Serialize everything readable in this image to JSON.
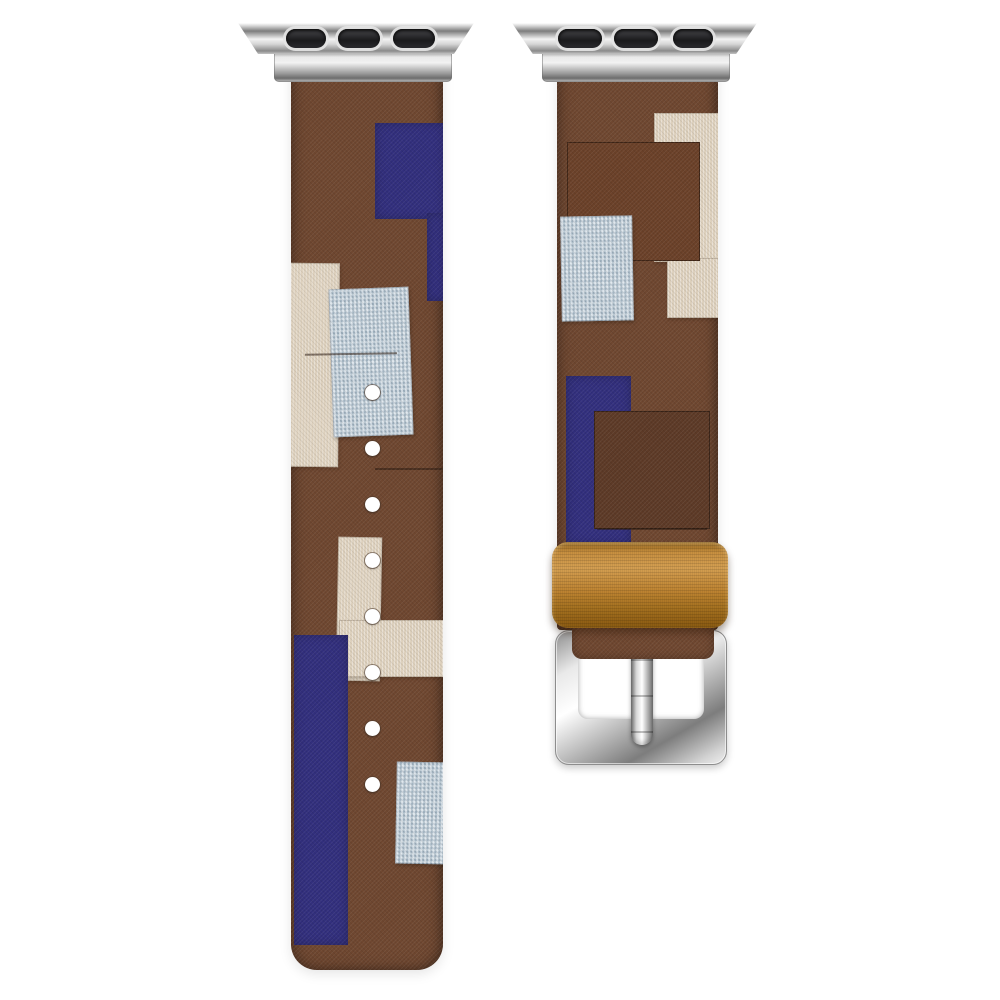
{
  "meta": {
    "type": "product-photo",
    "subject": "Patchwork fabric watch band with silver lug adapters and pin buckle",
    "background_style": "plain white studio background",
    "visible_text": ""
  },
  "product": {
    "pattern": "patchwork color-block fabric",
    "left_strap": {
      "holes_count": 8,
      "hole_color": "white"
    },
    "right_strap": {
      "has_keeper_loop": true,
      "has_buckle": true
    },
    "adapters": {
      "count": 2,
      "slots_per_adapter": 3,
      "finish": "polished silver"
    },
    "keeper": {
      "material_look": "tan leather"
    },
    "buckle": {
      "type": "pin buckle",
      "finish": "polished silver",
      "prong_count": 1
    }
  },
  "colors": {
    "background": "#ffffff",
    "brown": "#6f4730",
    "brown-red": "#6b4129",
    "brown-dark": "#5d3a27",
    "navy": "#322f7d",
    "lightblue": "#b6c8d5",
    "cream": "#ddd0bc",
    "tan": "#c08634",
    "tan-light": "#d49f52",
    "tan-dark": "#8a5a12",
    "metal-light": "#f2f2f2",
    "metal-mid": "#c4c4c4",
    "metal-dark": "#7d7d7d",
    "slot-black": "#1a1a1c",
    "hole-white": "#ffffff",
    "seam": "#2a1a10"
  }
}
